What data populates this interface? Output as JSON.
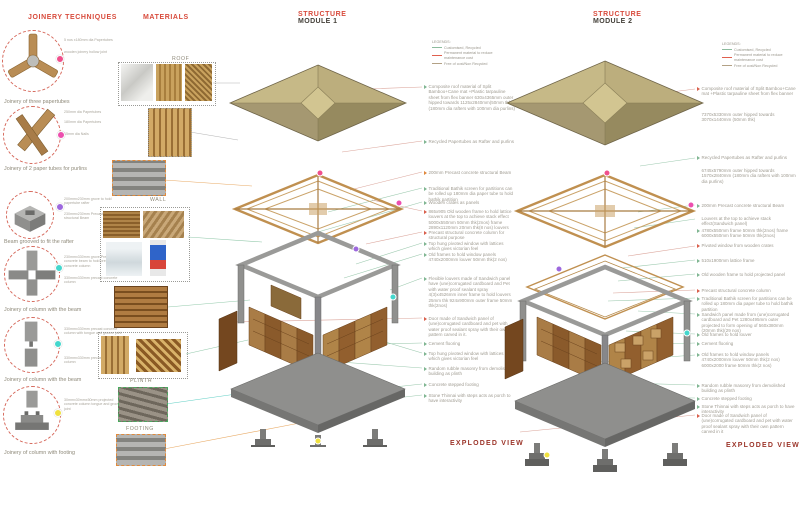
{
  "colors": {
    "accent_red": "#d84b3c",
    "header_dark": "#45413a",
    "annotation_gray": "#a09c92",
    "exploded_view_red": "#9c352a",
    "dot_pink": "#f0508c",
    "dot_magenta": "#ec4fae",
    "dot_purple": "#9d68de",
    "dot_teal": "#44d7cd",
    "dot_yellow": "#f0e13e",
    "legend_green": "#8cbb9d",
    "legend_red": "#e0604e",
    "legend_tan": "#b3a185",
    "roof_olive": "#b0a374",
    "wood_brown": "#8a5a2b",
    "concrete_gray": "#8f8f8d"
  },
  "joinery": {
    "title": "JOINERY TECHNIQUES",
    "items": [
      {
        "label": "Joinery of three papertubes",
        "notes": [
          "5 nos x180mm dia Papertubes",
          "wooden joinery hollow joint"
        ]
      },
      {
        "label": "Joinery of 2 paper tubes for purlins",
        "notes": [
          "250mm dia Papertubes",
          "180mm dia Papertubes",
          "15mm dia Nails"
        ]
      },
      {
        "label": "Beam grooved to fit the rafter",
        "notes": [
          "200mmx230mm grove to hold papertube rafter",
          "230mmx230mm Precast concrete structural Beam"
        ]
      },
      {
        "label": "Joinery of column with the beam",
        "notes": [
          "230mmx330mm grove Precast concrete beam to hold precast concrete column",
          "330mmx330mm precast concrete column"
        ]
      },
      {
        "label": "Joinery of column with the beam",
        "notes": [
          "330mmx330mm precast concrete column with tongue and groove joint",
          "330mmx330mm precast concrete column"
        ]
      },
      {
        "label": "Joinery of column with footing",
        "notes": [
          "30mmx30mmx50mm projected concrete column tongue and groove joint"
        ]
      }
    ]
  },
  "materials": {
    "title": "MATERIALS",
    "labels": {
      "roof": "ROOF",
      "wall": "WALL",
      "plinth": "PLINTH",
      "footing": "FOOTING"
    }
  },
  "legend": {
    "title": "LEGENDS:",
    "entries": [
      {
        "label": "Customised, Recycled"
      },
      {
        "label": "Permanent material to reduce maintenance cost"
      },
      {
        "label": "Free of cost/Non Recycled"
      }
    ]
  },
  "module1": {
    "header": {
      "line1": "STRUCTURE",
      "line2": "MODULE 1"
    },
    "footer": "EXPLODED VIEW",
    "annotations": [
      {
        "text": "Composite roof material of Split Bamboo+Cane mat +Plastic tarpauline sheet from flex banner 630x4365mm outer hipped towards 1125x2840mm(50mm thk)(180mm dia rafters with 100mm dia purlins)"
      },
      {
        "text": "Recycled Papertubes as Rafter and purlins"
      },
      {
        "text": "200mm Precast concrete structural Beam"
      },
      {
        "text": "Traditional Bathik screen for partitions can be rolled up 180mm dia paper tube to hold bathik partition"
      },
      {
        "text": "Wooden crates as panels"
      },
      {
        "text": "865x905 Old wooden frame to hold lattice louvers at the top to achieve stack effect 5000x550mm 50mm thk(2nos) frame 2890x1120mm 20mm thk(8 nos) louvers"
      },
      {
        "text": "Precast structural concrete column for structural purpose"
      },
      {
        "text": "Top hung pivoted window with lattices which gives victorian feel"
      },
      {
        "text": "Old frames to hold window panels 4740x2000mm louver 50mm thk(2 nos)"
      },
      {
        "text": "Flexible louvers made of Sandwich panel have (une)corrugated cardboard and Pet with water proof sealant spray 4(3)x4526mm inner frame to hold louvers 25mm thk 924x900mm outer frame 50mm thk(2nos)"
      },
      {
        "text": "Door made of Sandwich panel of (une)corrugated cardboard and pet with water proof sealant spray with their own pattern carved in it."
      },
      {
        "text": "Cement flooring"
      },
      {
        "text": "Top hung pivoted window with lattices which gives victorian feel"
      },
      {
        "text": "Random rubble masonry from demolished building as plinth"
      },
      {
        "text": "Concrete stepped footing"
      },
      {
        "text": "Stone Thinnai with steps acts as porch to have interactivity"
      }
    ]
  },
  "module2": {
    "header": {
      "line1": "STRUCTURE",
      "line2": "MODULE 2"
    },
    "footer": "EXPLODED VIEW",
    "annotations": [
      {
        "text": "Composite roof material of Split Bamboo+Cane mat +Plastic tarpauline sheet from flex banner"
      },
      {
        "text": "7370x5330mm outer hipped towards 3070x1440mm (50mm thk)"
      },
      {
        "text": "Recycled Papertubes as Rafter and purlins"
      },
      {
        "text": "6745x5790mm outer hipped towards 1570x2840mm (180mm dia rafters with 100mm dia purlins)"
      },
      {
        "text": "200mm Precast concrete structural Beam"
      },
      {
        "text": "Louvers at the top to achieve stack effect(Sandwich panel)"
      },
      {
        "text": "4780x550mm frame 50mm thk(2nos) frame 6000x550mm frame 50mm thk(2nos)"
      },
      {
        "text": "Pivoted window from wooden crates"
      },
      {
        "text": "510x1900mm lattice frame"
      },
      {
        "text": "Old wooden frame to hold projected panel"
      },
      {
        "text": "Precast structural concrete column"
      },
      {
        "text": "Traditional Bathik screen for partitions can be rolled up 180mm dia paper tube to hold bathik partition"
      },
      {
        "text": "Sandwich panel made from (une)corrugated cardboard and Pet 1280x495mm outer projected to form opening of 560x380mm (20mm thk)(29 nos)"
      },
      {
        "text": "Old frames to hold louver"
      },
      {
        "text": "Cement flooring"
      },
      {
        "text": "Old frames to hold window panels 4740x2000mm louver 50mm thk(2 nos) 6000x2000 frame 50mm thk(2 nos)"
      },
      {
        "text": "Random rubble masonry from demolished building as plinth"
      },
      {
        "text": "Concrete stepped footing"
      },
      {
        "text": "Stone Thinnai with steps acts as porch to have interactivity"
      },
      {
        "text": "Door made of Sandwich panel of (une)corrugated cardboard and pet with water proof sealant spray with their own pattern carved in it"
      }
    ]
  }
}
